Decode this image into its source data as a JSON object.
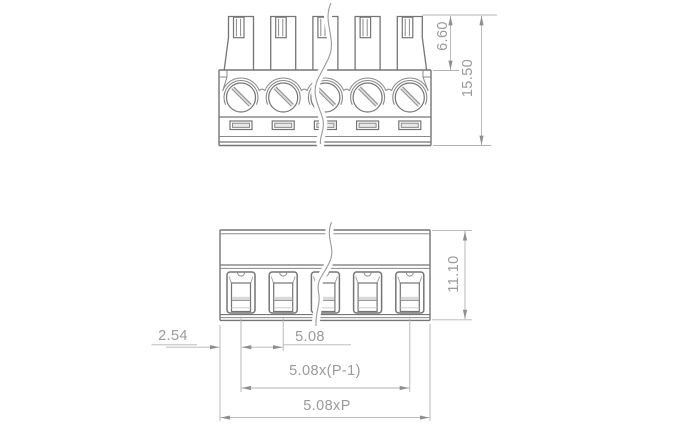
{
  "labels": {
    "clamp_height": "6.60",
    "total_height": "15.50",
    "body_height": "11.10",
    "edge_offset": "2.54",
    "pitch": "5.08",
    "pole_span": "5.08x(P-1)",
    "total_width": "5.08xP"
  },
  "colors": {
    "outline": "#757575",
    "medium_line": "#8a8a8a",
    "dimension_line": "#b3b3b3",
    "arrow": "#8f8f8f",
    "text": "#9a9a9a",
    "shade": "#d9d9d9",
    "background": "#ffffff"
  }
}
